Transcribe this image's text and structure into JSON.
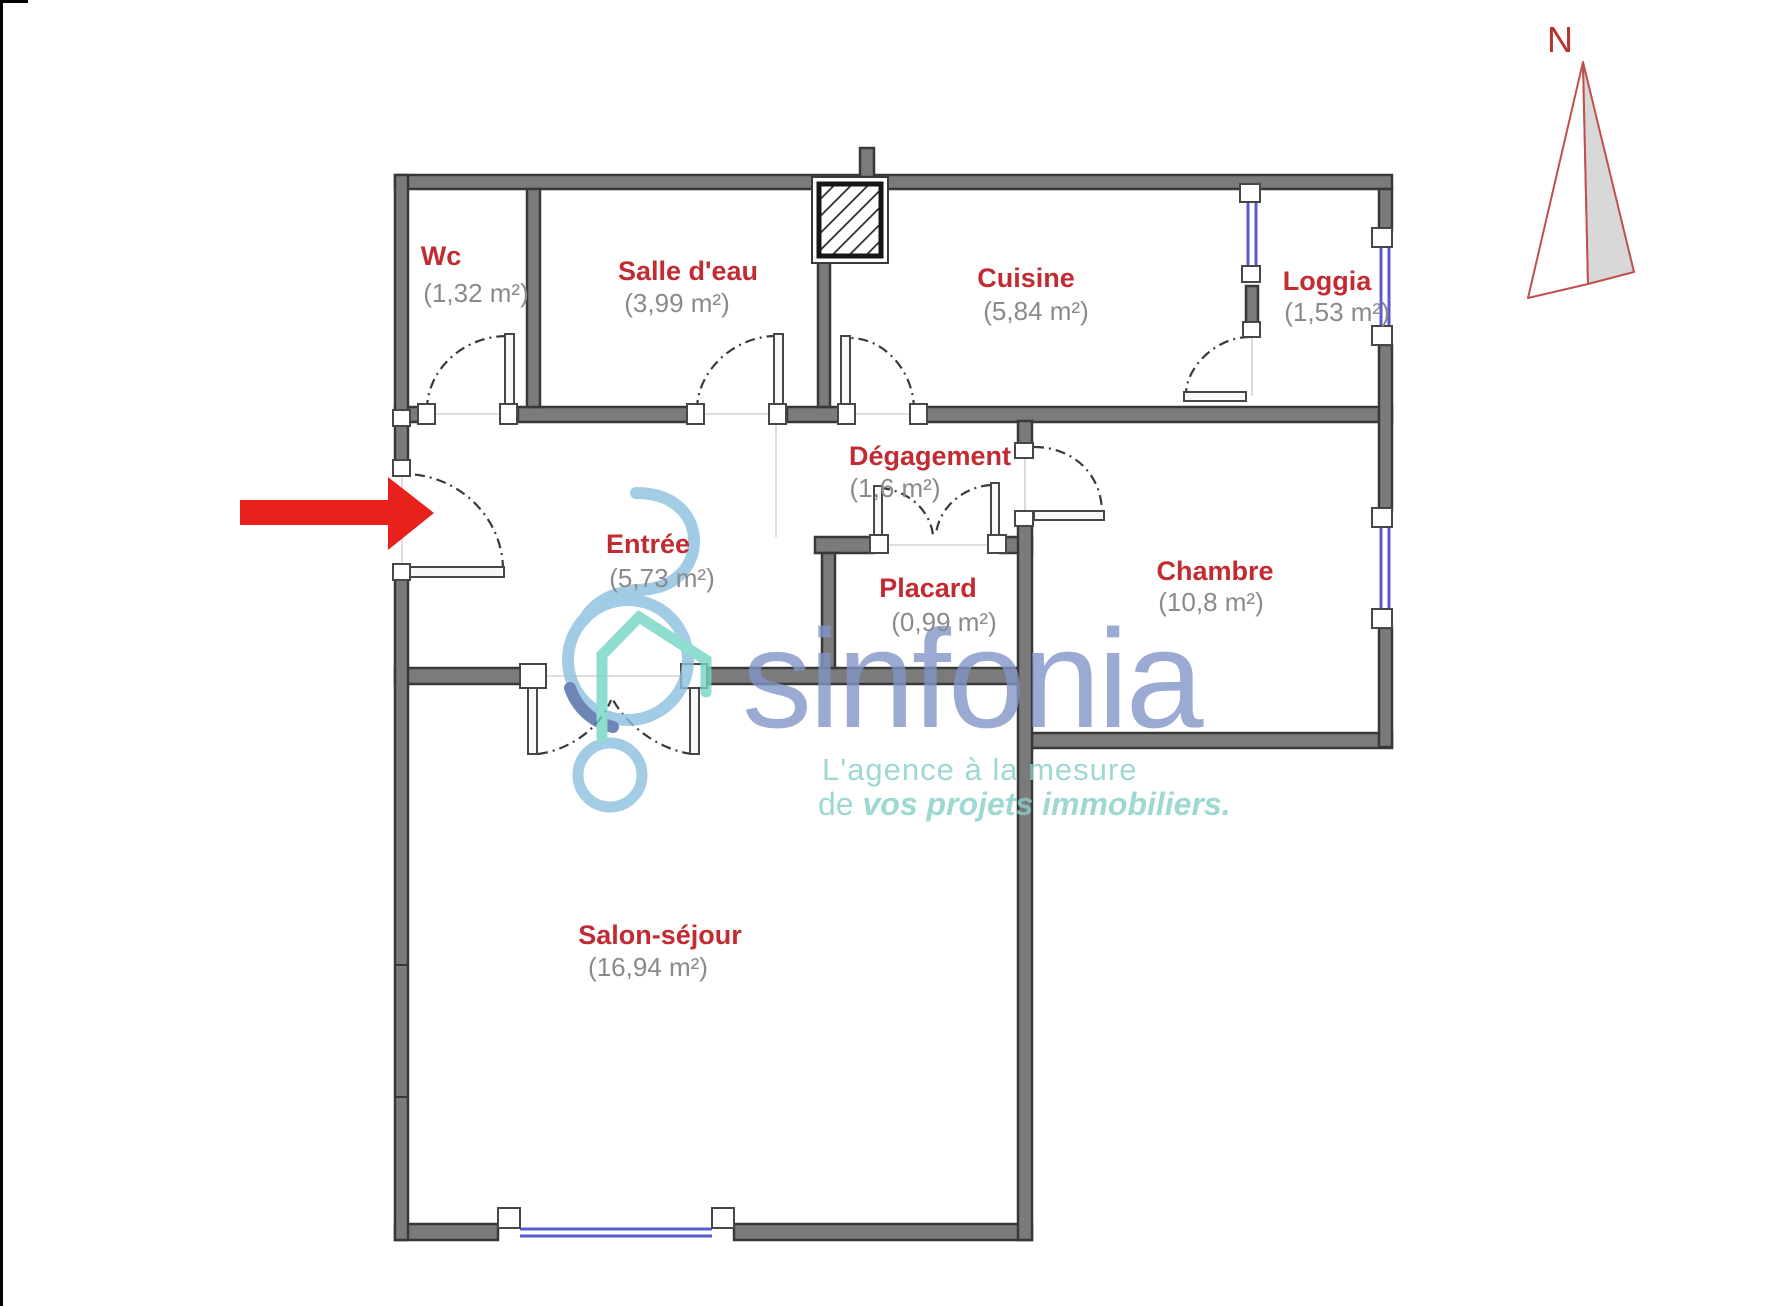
{
  "page": {
    "kind": "real-estate floor plan"
  },
  "rooms": [
    {
      "id": "wc",
      "name": "Wc",
      "area": "(1,32 m²)"
    },
    {
      "id": "salle-deau",
      "name": "Salle d'eau",
      "area": "(3,99 m²)"
    },
    {
      "id": "cuisine",
      "name": "Cuisine",
      "area": "(5,84 m²)"
    },
    {
      "id": "loggia",
      "name": "Loggia",
      "area": "(1,53 m²)"
    },
    {
      "id": "degagement",
      "name": "Dégagement",
      "area": "(1,6 m²)"
    },
    {
      "id": "entree",
      "name": "Entrée",
      "area": "(5,73 m²)"
    },
    {
      "id": "placard",
      "name": "Placard",
      "area": "(0,99 m²)"
    },
    {
      "id": "chambre",
      "name": "Chambre",
      "area": "(10,8 m²)"
    },
    {
      "id": "salon",
      "name": "Salon-séjour",
      "area": "(16,94 m²)"
    }
  ],
  "compass": {
    "north": "N"
  },
  "brand": {
    "name": "sinfonia",
    "tagline_line1": "L'agence à la mesure",
    "tagline_line2_prefix": "de ",
    "tagline_line2_emphasis": "vos projets immobiliers."
  },
  "colors": {
    "room_label": "#c12b31",
    "area_label": "#8a8a8a",
    "wall": "#7b7b7b",
    "wall_edge": "#383838",
    "window": "#5b5bd0",
    "entrance_arrow": "#e8211d",
    "compass": "#b5342e",
    "brand_text": "#8295c8",
    "tagline": "#87cfc8"
  }
}
